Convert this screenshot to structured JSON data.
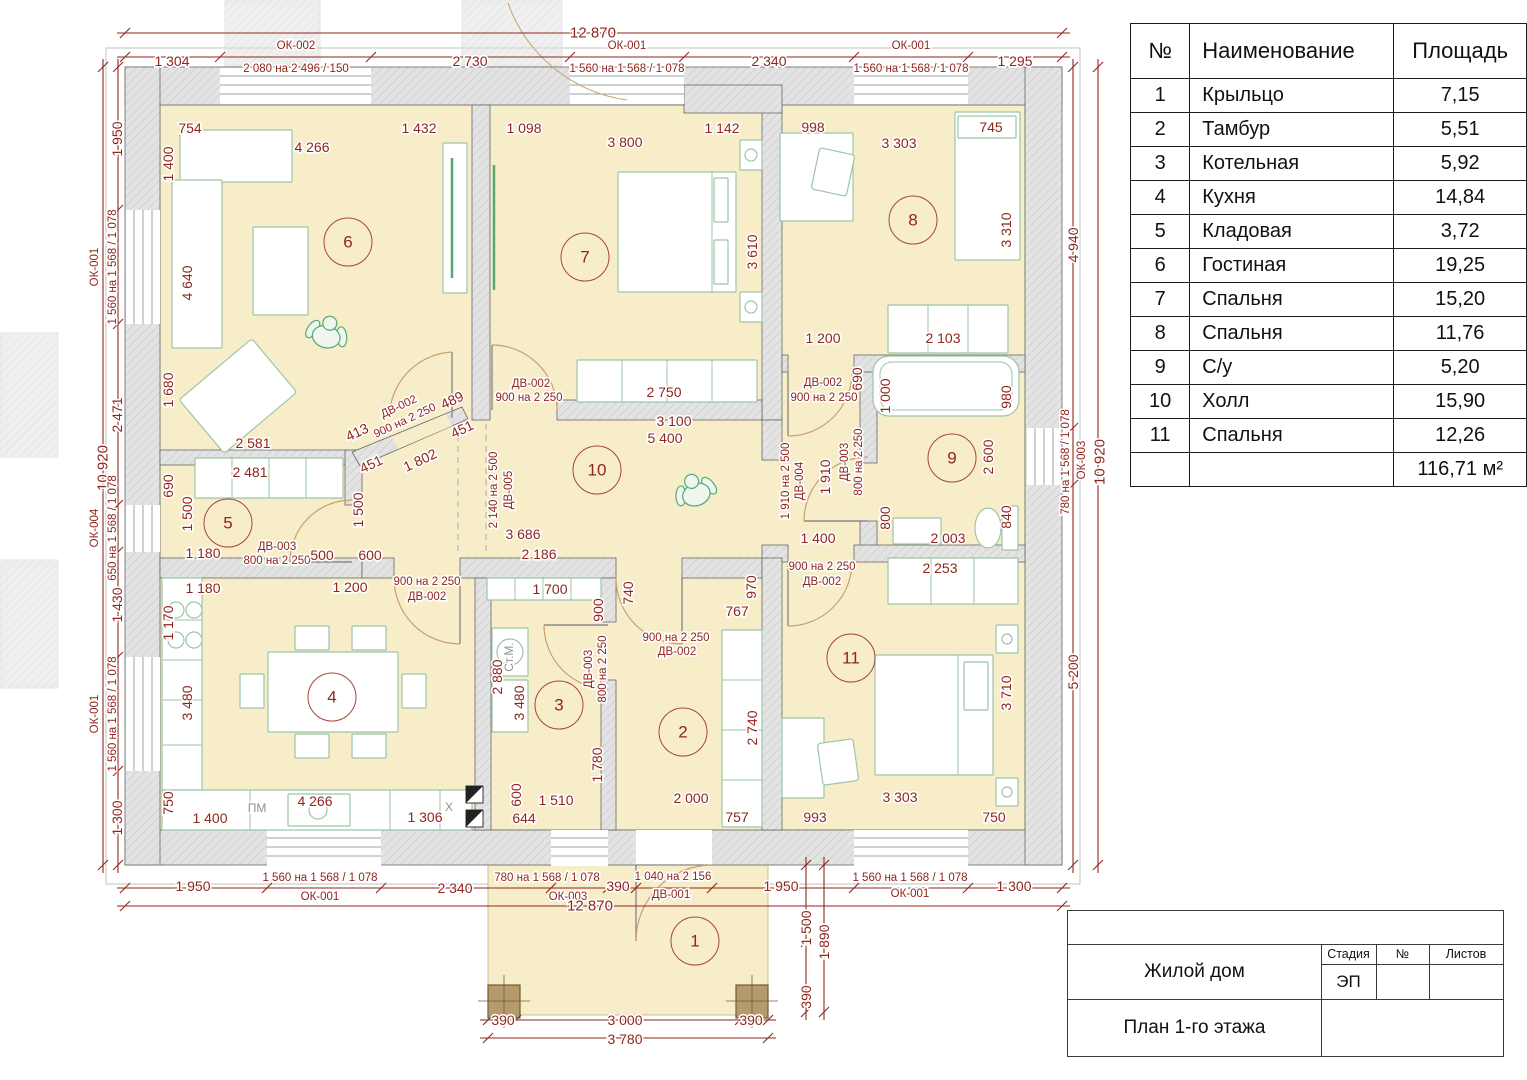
{
  "schedule": {
    "headers": [
      "№",
      "Наименование",
      "Площадь"
    ],
    "rows": [
      {
        "num": "1",
        "name": "Крыльцо",
        "area": "7,15"
      },
      {
        "num": "2",
        "name": "Тамбур",
        "area": "5,51"
      },
      {
        "num": "3",
        "name": "Котельная",
        "area": "5,92"
      },
      {
        "num": "4",
        "name": "Кухня",
        "area": "14,84"
      },
      {
        "num": "5",
        "name": "Кладовая",
        "area": "3,72"
      },
      {
        "num": "6",
        "name": "Гостиная",
        "area": "19,25"
      },
      {
        "num": "7",
        "name": "Спальня",
        "area": "15,20"
      },
      {
        "num": "8",
        "name": "Спальня",
        "area": "11,76"
      },
      {
        "num": "9",
        "name": "С/у",
        "area": "5,20"
      },
      {
        "num": "10",
        "name": "Холл",
        "area": "15,90"
      },
      {
        "num": "11",
        "name": "Спальня",
        "area": "12,26"
      }
    ],
    "total": "116,71 м²"
  },
  "title_block": {
    "project": "Жилой дом",
    "sheet_name": "План 1-го этажа",
    "stage_label": "Стадия",
    "num_label": "№",
    "sheets_label": "Листов",
    "stage_value": "ЭП"
  },
  "plan": {
    "colors": {
      "dim_text": "#8f261d",
      "gray_text": "#909090",
      "room_fill": "#f8edc9",
      "wall_fill": "#e3e3e3",
      "wall_stroke": "#666666",
      "furniture_stroke": "#9cc5a9",
      "accent_green": "#57a877",
      "door_arc": "#c9a06b",
      "column_fill": "#b59a6c"
    },
    "rooms": [
      {
        "n": "1",
        "x": 695,
        "y": 941
      },
      {
        "n": "2",
        "x": 683,
        "y": 732
      },
      {
        "n": "3",
        "x": 559,
        "y": 705
      },
      {
        "n": "4",
        "x": 332,
        "y": 697
      },
      {
        "n": "5",
        "x": 228,
        "y": 523
      },
      {
        "n": "6",
        "x": 348,
        "y": 242
      },
      {
        "n": "7",
        "x": 585,
        "y": 257
      },
      {
        "n": "8",
        "x": 913,
        "y": 220
      },
      {
        "n": "9",
        "x": 952,
        "y": 458
      },
      {
        "n": "10",
        "x": 597,
        "y": 470
      },
      {
        "n": "11",
        "x": 851,
        "y": 658
      }
    ],
    "labels": [
      {
        "t": "12 870",
        "x": 593,
        "y": 33,
        "s": 15
      },
      {
        "t": "1 304",
        "x": 172,
        "y": 61
      },
      {
        "t": "ОК-002",
        "x": 296,
        "y": 46,
        "k": "spec"
      },
      {
        "t": "2 080 на 2 496 / 150",
        "x": 296,
        "y": 69,
        "k": "spec"
      },
      {
        "t": "2 730",
        "x": 470,
        "y": 61
      },
      {
        "t": "ОК-001",
        "x": 627,
        "y": 46,
        "k": "spec"
      },
      {
        "t": "1 560 на 1 568 / 1 078",
        "x": 627,
        "y": 69,
        "k": "spec"
      },
      {
        "t": "2 340",
        "x": 769,
        "y": 61
      },
      {
        "t": "ОК-001",
        "x": 911,
        "y": 46,
        "k": "spec"
      },
      {
        "t": "1 560 на 1 568 / 1 078",
        "x": 911,
        "y": 69,
        "k": "spec"
      },
      {
        "t": "1 295",
        "x": 1015,
        "y": 61
      },
      {
        "t": "754",
        "x": 190,
        "y": 128
      },
      {
        "t": "4 266",
        "x": 312,
        "y": 147
      },
      {
        "t": "1 432",
        "x": 419,
        "y": 128
      },
      {
        "t": "1 098",
        "x": 524,
        "y": 128
      },
      {
        "t": "3 800",
        "x": 625,
        "y": 142
      },
      {
        "t": "1 142",
        "x": 722,
        "y": 128
      },
      {
        "t": "998",
        "x": 813,
        "y": 127
      },
      {
        "t": "3 303",
        "x": 899,
        "y": 143
      },
      {
        "t": "745",
        "x": 991,
        "y": 127
      },
      {
        "t": "10 920",
        "x": 103,
        "y": 468,
        "r": -90,
        "s": 15
      },
      {
        "t": "1 950",
        "x": 117,
        "y": 139,
        "r": -90
      },
      {
        "t": "ОК-001",
        "x": 95,
        "y": 267,
        "r": -90,
        "k": "spec"
      },
      {
        "t": "1 560 на 1 568 / 1 078",
        "x": 113,
        "y": 267,
        "r": -90,
        "k": "spec"
      },
      {
        "t": "2 471",
        "x": 117,
        "y": 415,
        "r": -90
      },
      {
        "t": "ОК-004",
        "x": 95,
        "y": 528,
        "r": -90,
        "k": "spec"
      },
      {
        "t": "650 на 1 568 / 1 078",
        "x": 113,
        "y": 528,
        "r": -90,
        "k": "spec"
      },
      {
        "t": "1 430",
        "x": 117,
        "y": 605,
        "r": -90
      },
      {
        "t": "ОК-001",
        "x": 95,
        "y": 714,
        "r": -90,
        "k": "spec"
      },
      {
        "t": "1 560 на 1 568 / 1 078",
        "x": 113,
        "y": 714,
        "r": -90,
        "k": "spec"
      },
      {
        "t": "1 300",
        "x": 117,
        "y": 818,
        "r": -90
      },
      {
        "t": "1 400",
        "x": 168,
        "y": 164,
        "r": -90
      },
      {
        "t": "4 640",
        "x": 187,
        "y": 283,
        "r": -90
      },
      {
        "t": "1 680",
        "x": 168,
        "y": 390,
        "r": -90
      },
      {
        "t": "690",
        "x": 168,
        "y": 486,
        "r": -90
      },
      {
        "t": "1 500",
        "x": 187,
        "y": 514,
        "r": -90
      },
      {
        "t": "1 170",
        "x": 168,
        "y": 623,
        "r": -90
      },
      {
        "t": "3 480",
        "x": 187,
        "y": 703,
        "r": -90
      },
      {
        "t": "750",
        "x": 168,
        "y": 803,
        "r": -90
      },
      {
        "t": "4 940",
        "x": 1073,
        "y": 245,
        "r": -90
      },
      {
        "t": "780 на 1 568 / 1 078",
        "x": 1066,
        "y": 462,
        "r": -90,
        "k": "spec"
      },
      {
        "t": "ОК-003",
        "x": 1082,
        "y": 460,
        "r": -90,
        "k": "spec"
      },
      {
        "t": "10 920",
        "x": 1100,
        "y": 462,
        "r": -90,
        "s": 15
      },
      {
        "t": "5 200",
        "x": 1073,
        "y": 672,
        "r": -90
      },
      {
        "t": "3 610",
        "x": 752,
        "y": 252,
        "r": -90
      },
      {
        "t": "3 310",
        "x": 1006,
        "y": 230,
        "r": -90
      },
      {
        "t": "980",
        "x": 1006,
        "y": 397,
        "r": -90
      },
      {
        "t": "2 600",
        "x": 988,
        "y": 457,
        "r": -90
      },
      {
        "t": "840",
        "x": 1006,
        "y": 517,
        "r": -90
      },
      {
        "t": "3 710",
        "x": 1006,
        "y": 693,
        "r": -90
      },
      {
        "t": "2 581",
        "x": 253,
        "y": 443
      },
      {
        "t": "413",
        "x": 357,
        "y": 432,
        "r": -25
      },
      {
        "t": "ДВ-002",
        "x": 399,
        "y": 407,
        "r": -25,
        "k": "spec"
      },
      {
        "t": "900 на 2 250",
        "x": 405,
        "y": 421,
        "r": -25,
        "k": "spec"
      },
      {
        "t": "489",
        "x": 452,
        "y": 400,
        "r": -25
      },
      {
        "t": "451",
        "x": 371,
        "y": 464,
        "r": -25
      },
      {
        "t": "1 802",
        "x": 420,
        "y": 460,
        "r": -25
      },
      {
        "t": "451",
        "x": 462,
        "y": 429,
        "r": -25
      },
      {
        "t": "ДВ-002",
        "x": 531,
        "y": 384,
        "k": "spec"
      },
      {
        "t": "900 на 2 250",
        "x": 529,
        "y": 398,
        "k": "spec"
      },
      {
        "t": "2 750",
        "x": 664,
        "y": 392
      },
      {
        "t": "3 100",
        "x": 674,
        "y": 421
      },
      {
        "t": "5 400",
        "x": 665,
        "y": 438
      },
      {
        "t": "1 200",
        "x": 823,
        "y": 338
      },
      {
        "t": "2 103",
        "x": 943,
        "y": 338
      },
      {
        "t": "690",
        "x": 857,
        "y": 379,
        "r": -90
      },
      {
        "t": "ДВ-002",
        "x": 823,
        "y": 383,
        "k": "spec"
      },
      {
        "t": "900 на 2 250",
        "x": 824,
        "y": 398,
        "k": "spec"
      },
      {
        "t": "1 000",
        "x": 885,
        "y": 396,
        "r": -90
      },
      {
        "t": "1 910 на 2 500",
        "x": 786,
        "y": 481,
        "r": -90,
        "k": "spec"
      },
      {
        "t": "ДВ-004",
        "x": 800,
        "y": 481,
        "r": -90,
        "k": "spec"
      },
      {
        "t": "1 910",
        "x": 825,
        "y": 477,
        "r": -90
      },
      {
        "t": "ДВ-003",
        "x": 845,
        "y": 462,
        "r": -90,
        "k": "spec"
      },
      {
        "t": "800 на 2 250",
        "x": 859,
        "y": 462,
        "r": -90,
        "k": "spec"
      },
      {
        "t": "800",
        "x": 885,
        "y": 518,
        "r": -90
      },
      {
        "t": "2 003",
        "x": 948,
        "y": 538
      },
      {
        "t": "1 400",
        "x": 818,
        "y": 538
      },
      {
        "t": "900 на 2 250",
        "x": 822,
        "y": 567,
        "k": "spec"
      },
      {
        "t": "ДВ-002",
        "x": 822,
        "y": 582,
        "k": "spec"
      },
      {
        "t": "2 253",
        "x": 940,
        "y": 568
      },
      {
        "t": "1 500",
        "x": 358,
        "y": 510,
        "r": -90
      },
      {
        "t": "2 140 на 2 500",
        "x": 494,
        "y": 490,
        "r": -90,
        "k": "spec"
      },
      {
        "t": "ДВ-005",
        "x": 509,
        "y": 490,
        "r": -90,
        "k": "spec"
      },
      {
        "t": "3 686",
        "x": 523,
        "y": 534
      },
      {
        "t": "2 186",
        "x": 539,
        "y": 554
      },
      {
        "t": "600",
        "x": 370,
        "y": 555
      },
      {
        "t": "1 700",
        "x": 550,
        "y": 589
      },
      {
        "t": "740",
        "x": 628,
        "y": 593,
        "r": -90
      },
      {
        "t": "900",
        "x": 598,
        "y": 610,
        "r": -90
      },
      {
        "t": "970",
        "x": 751,
        "y": 587,
        "r": -90
      },
      {
        "t": "767",
        "x": 737,
        "y": 611
      },
      {
        "t": "900 на 2 250",
        "x": 427,
        "y": 582,
        "k": "spec"
      },
      {
        "t": "ДВ-002",
        "x": 427,
        "y": 597,
        "k": "spec"
      },
      {
        "t": "2 481",
        "x": 250,
        "y": 472
      },
      {
        "t": "1 180",
        "x": 203,
        "y": 553
      },
      {
        "t": "ДВ-003",
        "x": 277,
        "y": 547,
        "k": "spec"
      },
      {
        "t": "800 на 2 250",
        "x": 277,
        "y": 561,
        "k": "spec"
      },
      {
        "t": "500",
        "x": 322,
        "y": 555
      },
      {
        "t": "1 180",
        "x": 203,
        "y": 588
      },
      {
        "t": "1 200",
        "x": 350,
        "y": 587
      },
      {
        "t": "1 400",
        "x": 210,
        "y": 818
      },
      {
        "t": "4 266",
        "x": 315,
        "y": 801
      },
      {
        "t": "1 306",
        "x": 425,
        "y": 817
      },
      {
        "t": "ПМ",
        "x": 257,
        "y": 808,
        "k": "gray"
      },
      {
        "t": "X",
        "x": 449,
        "y": 807,
        "k": "gray"
      },
      {
        "t": "Ст.М.",
        "x": 509,
        "y": 657,
        "r": -90,
        "k": "gray"
      },
      {
        "t": "2 880",
        "x": 497,
        "y": 677,
        "r": -90
      },
      {
        "t": "3 480",
        "x": 519,
        "y": 703,
        "r": -90
      },
      {
        "t": "ДВ-003",
        "x": 589,
        "y": 669,
        "r": -90,
        "k": "spec"
      },
      {
        "t": "800 на 2 250",
        "x": 603,
        "y": 669,
        "r": -90,
        "k": "spec"
      },
      {
        "t": "1 780",
        "x": 597,
        "y": 765,
        "r": -90
      },
      {
        "t": "1 510",
        "x": 556,
        "y": 800
      },
      {
        "t": "600",
        "x": 516,
        "y": 795,
        "r": -90
      },
      {
        "t": "644",
        "x": 524,
        "y": 818
      },
      {
        "t": "900 на 2 250",
        "x": 676,
        "y": 638,
        "k": "spec"
      },
      {
        "t": "ДВ-002",
        "x": 677,
        "y": 652,
        "k": "spec"
      },
      {
        "t": "2 740",
        "x": 752,
        "y": 728,
        "r": -90
      },
      {
        "t": "2 000",
        "x": 691,
        "y": 798
      },
      {
        "t": "757",
        "x": 737,
        "y": 817
      },
      {
        "t": "993",
        "x": 815,
        "y": 817
      },
      {
        "t": "3 303",
        "x": 900,
        "y": 797
      },
      {
        "t": "750",
        "x": 994,
        "y": 817
      },
      {
        "t": "1 950",
        "x": 193,
        "y": 886
      },
      {
        "t": "1 560 на 1 568 / 1 078",
        "x": 320,
        "y": 878,
        "k": "spec"
      },
      {
        "t": "ОК-001",
        "x": 320,
        "y": 897,
        "k": "spec"
      },
      {
        "t": "2 340",
        "x": 455,
        "y": 888
      },
      {
        "t": "780 на 1 568 / 1 078",
        "x": 547,
        "y": 878,
        "k": "spec"
      },
      {
        "t": "ОК-003",
        "x": 568,
        "y": 897,
        "k": "spec"
      },
      {
        "t": "12 870",
        "x": 590,
        "y": 906,
        "s": 15
      },
      {
        "t": "390",
        "x": 618,
        "y": 886
      },
      {
        "t": "1 040 на 2 156",
        "x": 673,
        "y": 877,
        "k": "spec"
      },
      {
        "t": "ДВ-001",
        "x": 671,
        "y": 895,
        "k": "spec"
      },
      {
        "t": "1 950",
        "x": 781,
        "y": 886
      },
      {
        "t": "1 560 на 1 568 / 1 078",
        "x": 910,
        "y": 878,
        "k": "spec"
      },
      {
        "t": "ОК-001",
        "x": 910,
        "y": 894,
        "k": "spec"
      },
      {
        "t": "1 300",
        "x": 1014,
        "y": 886
      },
      {
        "t": "1 500",
        "x": 806,
        "y": 928,
        "r": -90
      },
      {
        "t": "1 890",
        "x": 824,
        "y": 942,
        "r": -90
      },
      {
        "t": "390",
        "x": 806,
        "y": 997,
        "r": -90
      },
      {
        "t": "390",
        "x": 503,
        "y": 1020
      },
      {
        "t": "3 000",
        "x": 625,
        "y": 1020
      },
      {
        "t": "390",
        "x": 751,
        "y": 1020
      },
      {
        "t": "3 780",
        "x": 625,
        "y": 1039
      }
    ]
  }
}
